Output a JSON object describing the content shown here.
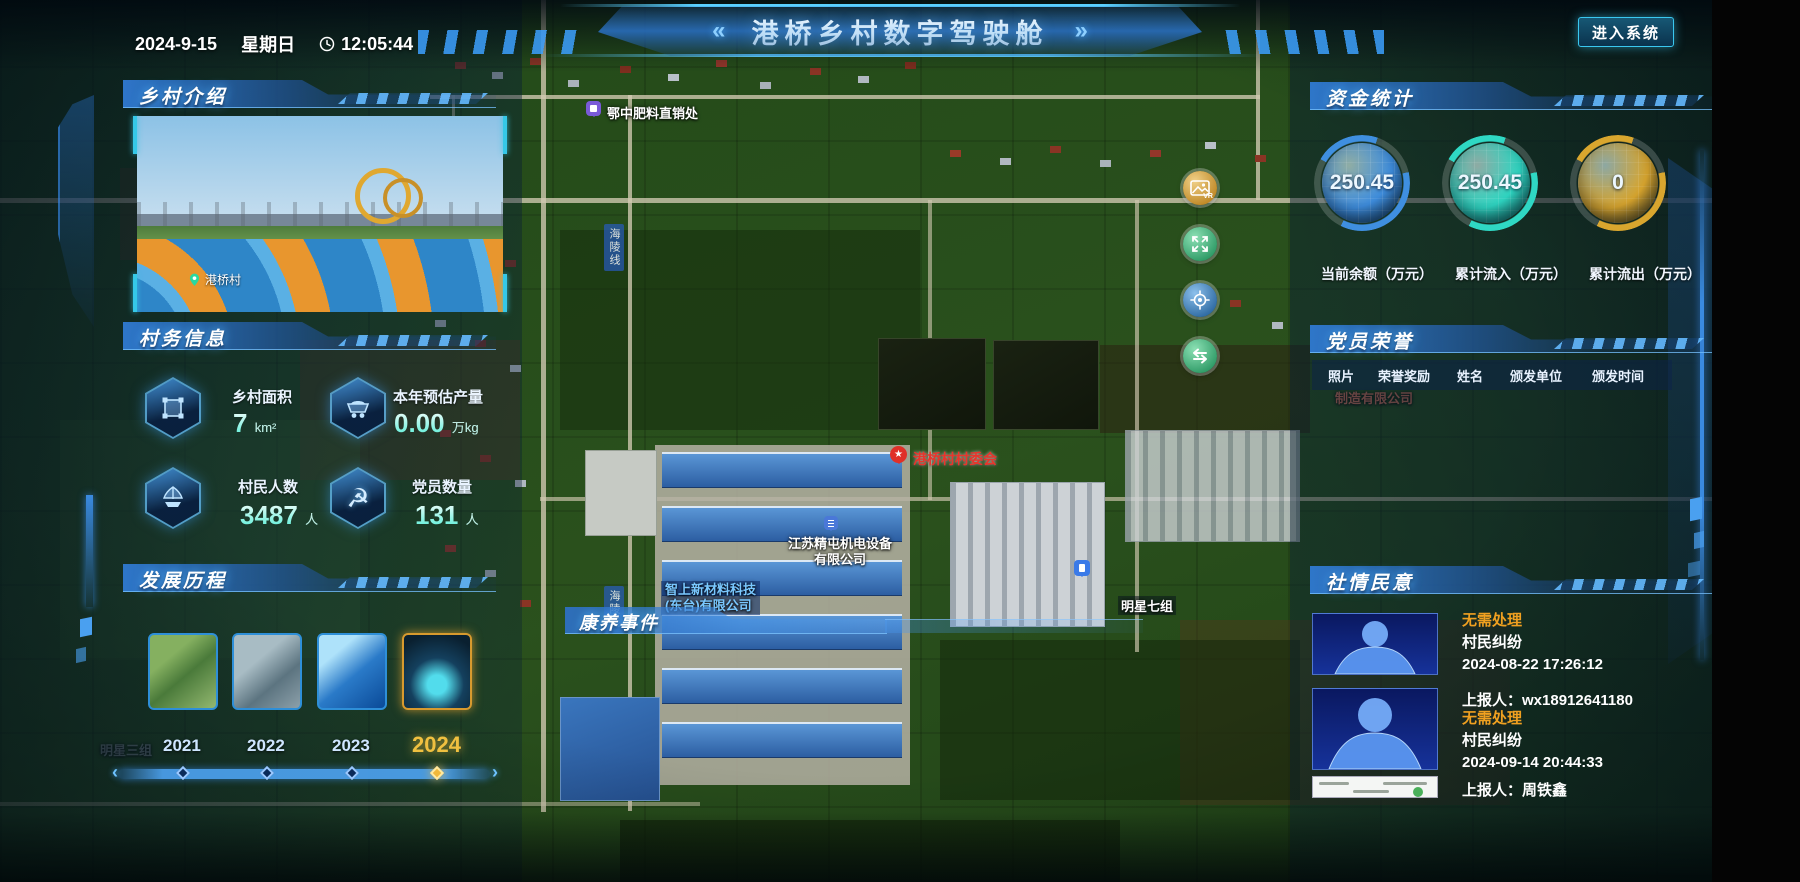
{
  "header": {
    "date": "2024-9-15",
    "weekday": "星期日",
    "time": "12:05:44",
    "title": "港桥乡村数字驾驶舱",
    "left_deco": "«",
    "right_deco": "»",
    "enter_button": "进入系统"
  },
  "intro": {
    "title": "乡村介绍",
    "photo_caption": "港桥村"
  },
  "village_info": {
    "title": "村务信息",
    "stats": [
      {
        "icon": "land-area-icon",
        "label": "乡村面积",
        "value": "7",
        "unit": "km²"
      },
      {
        "icon": "cart-icon",
        "label": "本年预估产量",
        "value": "0.00",
        "unit": "万kg"
      },
      {
        "icon": "sailboat-icon",
        "label": "村民人数",
        "value": "3487",
        "unit": "人"
      },
      {
        "icon": "hammer-sickle-icon",
        "label": "党员数量",
        "value": "131",
        "unit": "人"
      }
    ]
  },
  "history": {
    "title": "发展历程",
    "years": [
      "2021",
      "2022",
      "2023",
      "2024"
    ],
    "selected_year": "2024"
  },
  "funds": {
    "title": "资金统计",
    "gauges": [
      {
        "value": "250.45",
        "label": "当前余额（万元）",
        "color": "#3f8fe0"
      },
      {
        "value": "250.45",
        "label": "累计流入（万元）",
        "color": "#2fd8c4"
      },
      {
        "value": "0",
        "label": "累计流出（万元）",
        "color": "#d9a62e"
      }
    ]
  },
  "honors": {
    "title": "党员荣誉",
    "columns": [
      "照片",
      "荣誉奖励",
      "姓名",
      "颁发单位",
      "颁发时间"
    ]
  },
  "sentiment": {
    "title": "社情民意",
    "items": [
      {
        "status": "无需处理",
        "category": "村民纠纷",
        "time": "2024-08-22 17:26:12",
        "reporter_label": "上报人：",
        "reporter": "wx18912641180"
      },
      {
        "status": "无需处理",
        "category": "村民纠纷",
        "time": "2024-09-14 20:44:33",
        "reporter_label": "上报人：",
        "reporter": "周铁鑫"
      }
    ]
  },
  "events_panel": {
    "title": "康养事件"
  },
  "map": {
    "labels": {
      "fertilizer": "鄂中肥料直销处",
      "village_committee": "港桥村村委会",
      "company1_line1": "江苏精屯机电设备",
      "company1_line2": "有限公司",
      "company2_line1": "智上新材料科技",
      "company2_line2": "(东台)有限公司",
      "group7": "明星七组",
      "group3": "明星三组",
      "road": "海陵线",
      "manufacture": "制造有限公司"
    },
    "buttons": [
      "vr",
      "fullscreen",
      "locate",
      "refresh"
    ]
  },
  "colors": {
    "accent": "#35c8e8",
    "status_orange": "#f0a020",
    "year_active": "#f0c040"
  }
}
